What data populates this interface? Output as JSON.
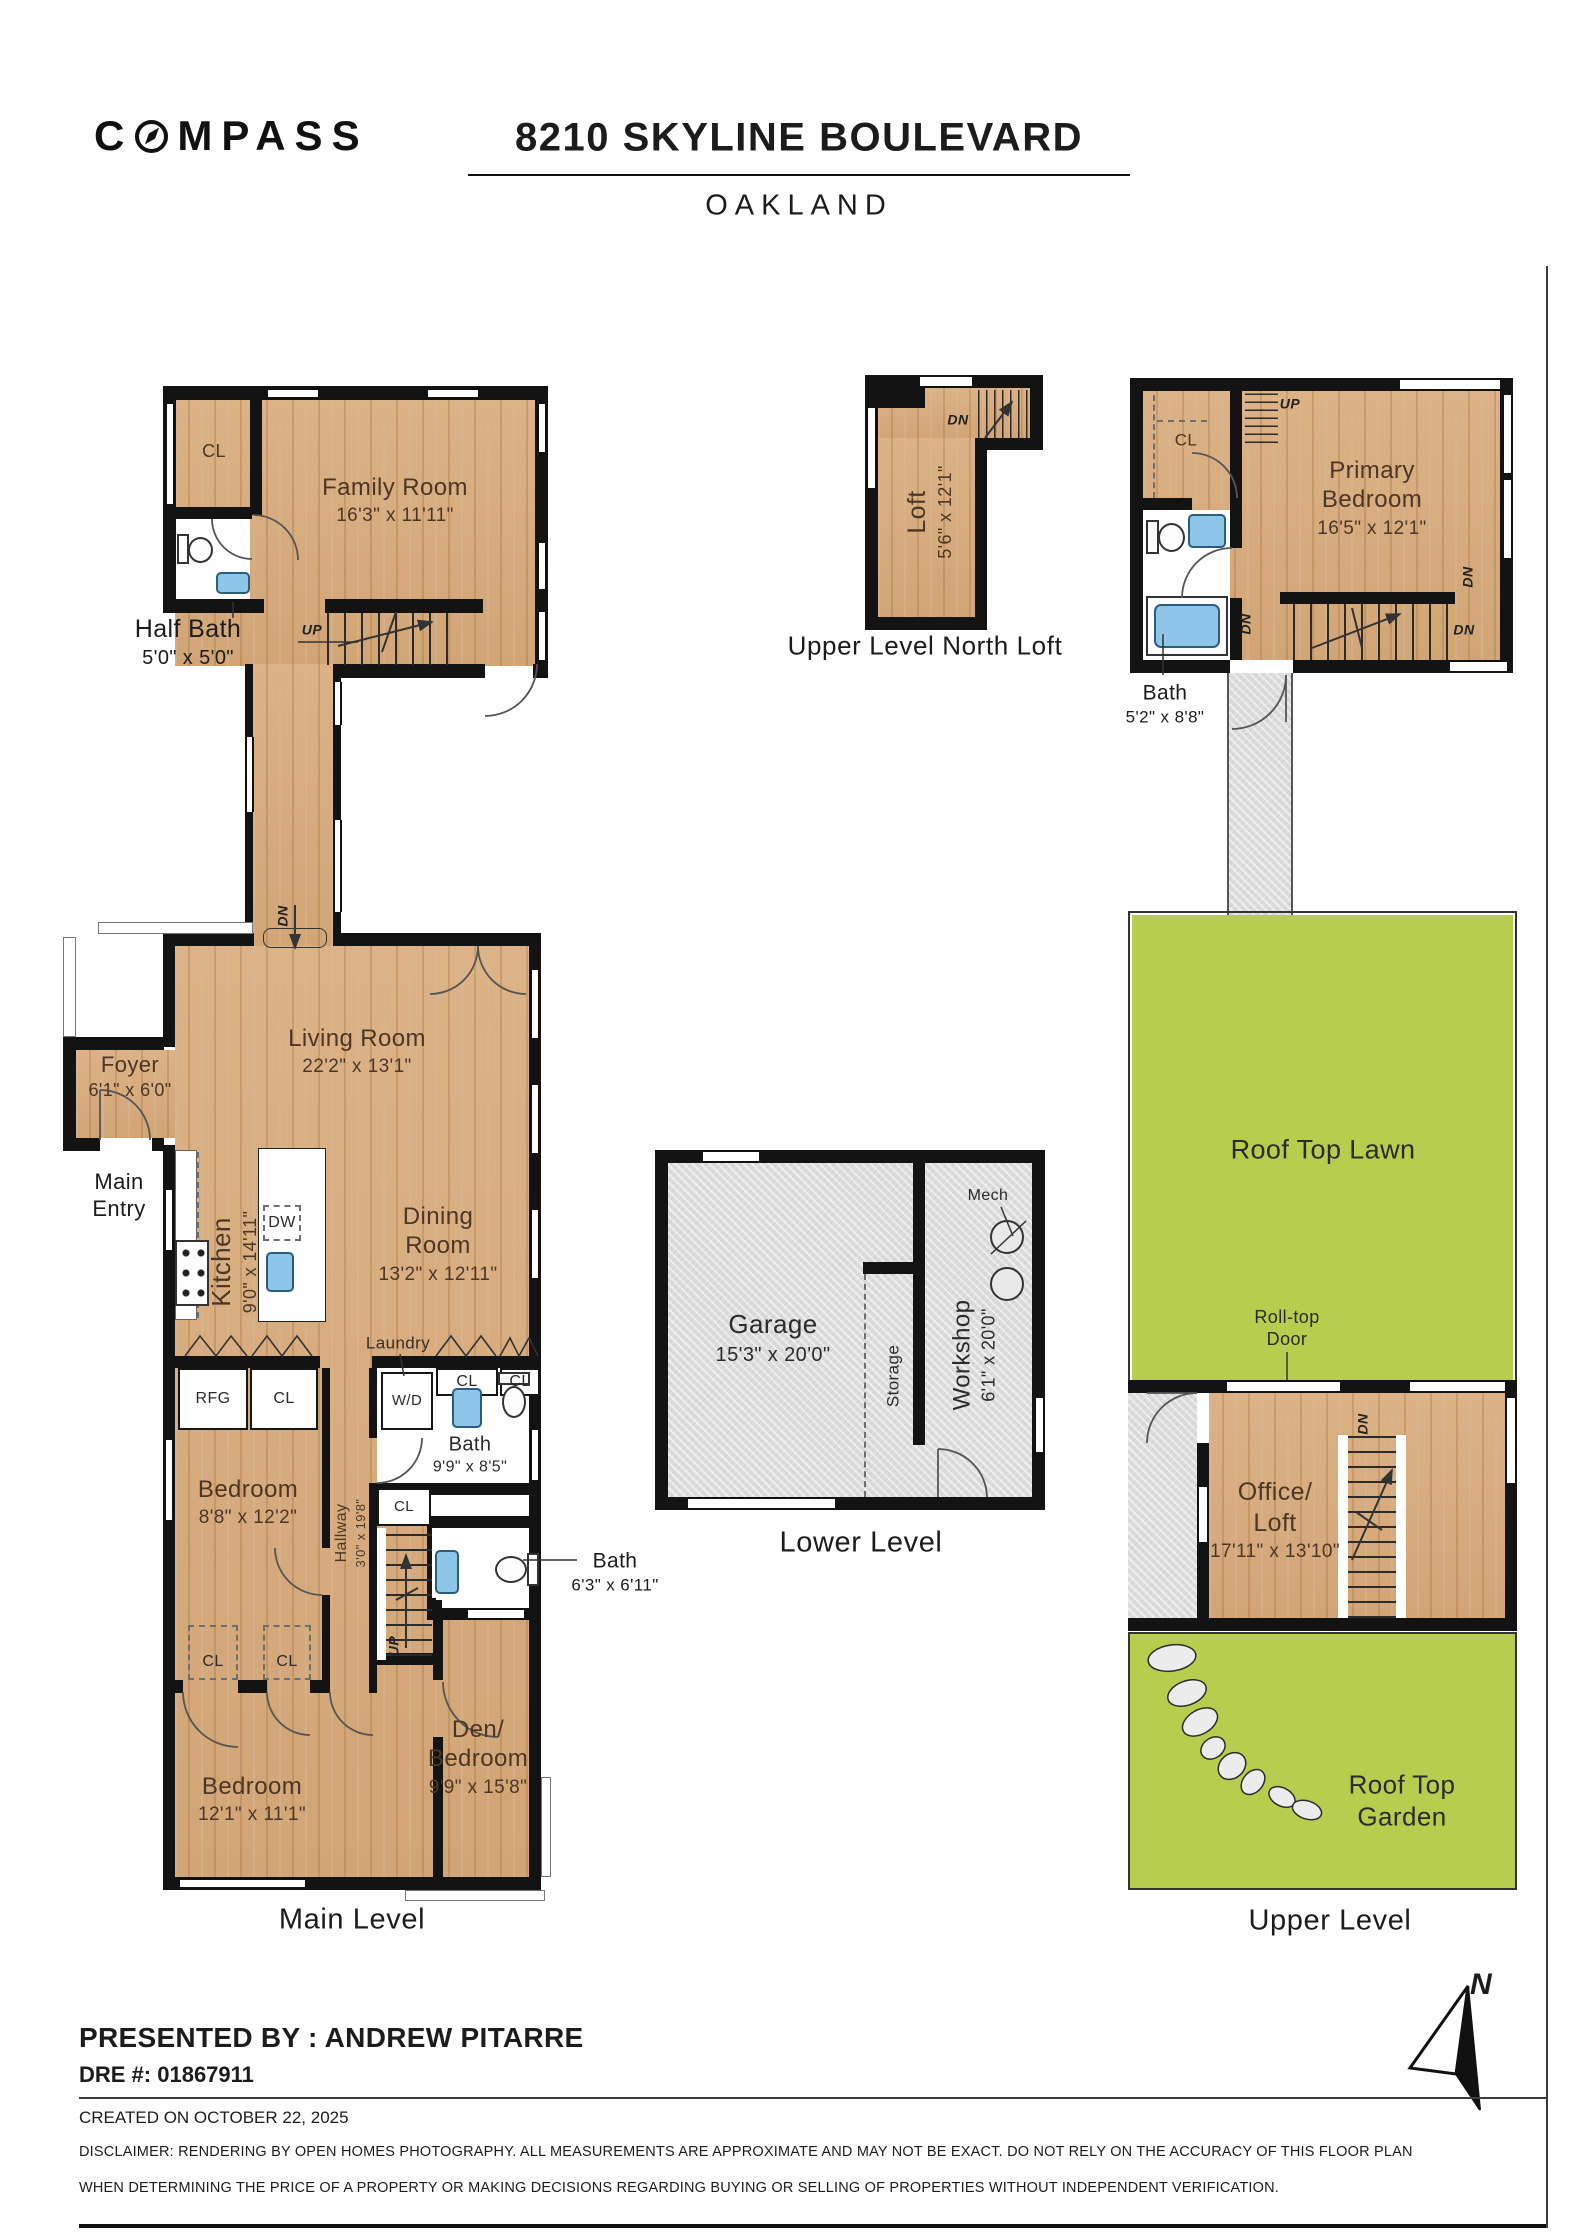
{
  "header": {
    "brand_c": "C",
    "brand_rest": "MPASS",
    "title": "8210 SKYLINE BOULEVARD",
    "subtitle": "OAKLAND"
  },
  "captions": {
    "north_loft": "Upper Level North Loft",
    "main_level": "Main Level",
    "lower_level": "Lower Level",
    "upper_level": "Upper Level"
  },
  "rooms": {
    "family_room": {
      "name": "Family Room",
      "dims": "16'3\" x 11'11\""
    },
    "half_bath": {
      "name": "Half Bath",
      "dims": "5'0\" x 5'0\""
    },
    "loft": {
      "name": "Loft",
      "dims": "5'6\" x 12'1\""
    },
    "primary": {
      "line1": "Primary",
      "line2": "Bedroom",
      "dims": "16'5\" x 12'1\""
    },
    "bath_upper": {
      "name": "Bath",
      "dims": "5'2\" x 8'8\""
    },
    "living": {
      "name": "Living Room",
      "dims": "22'2\" x 13'1\""
    },
    "foyer": {
      "name": "Foyer",
      "dims": "6'1\" x 6'0\""
    },
    "main_entry": {
      "line1": "Main",
      "line2": "Entry"
    },
    "kitchen": {
      "name": "Kitchen",
      "dims": "9'0\" x 14'11\""
    },
    "dining": {
      "line1": "Dining",
      "line2": "Room",
      "dims": "13'2\" x 12'11\""
    },
    "laundry": "Laundry",
    "bath_main": {
      "name": "Bath",
      "dims": "9'9\" x 8'5\""
    },
    "bath_hall": {
      "name": "Bath",
      "dims": "6'3\" x 6'11\""
    },
    "hallway": {
      "name": "Hallway",
      "dims": "3'0\" x 19'8\""
    },
    "bedroom_a": {
      "name": "Bedroom",
      "dims": "8'8\" x 12'2\""
    },
    "bedroom_b": {
      "name": "Bedroom",
      "dims": "12'1\" x 11'1\""
    },
    "den": {
      "line1": "Den/",
      "line2": "Bedroom",
      "dims": "9'9\" x 15'8\""
    },
    "garage": {
      "name": "Garage",
      "dims": "15'3\" x 20'0\""
    },
    "workshop": {
      "name": "Workshop",
      "dims": "6'1\" x 20'0\""
    },
    "storage": "Storage",
    "mech": "Mech",
    "lawn": "Roof Top Lawn",
    "roll_top": {
      "line1": "Roll-top",
      "line2": "Door"
    },
    "office": {
      "line1": "Office/",
      "line2": "Loft",
      "dims": "17'11\" x 13'10\""
    },
    "garden": {
      "line1": "Roof Top",
      "line2": "Garden"
    }
  },
  "markers": {
    "cl": "CL",
    "up": "UP",
    "dn": "DN",
    "rfg": "RFG",
    "dw": "DW",
    "wd": "W/D",
    "north": "N"
  },
  "footer": {
    "presented_by": "PRESENTED BY : ANDREW PITARRE",
    "dre": "DRE #: 01867911",
    "created": "CREATED ON OCTOBER 22, 2025",
    "disclaimer_line1": "DISCLAIMER: RENDERING BY OPEN HOMES PHOTOGRAPHY. ALL MEASUREMENTS ARE APPROXIMATE AND MAY NOT BE EXACT. DO NOT RELY ON THE ACCURACY OF THIS FLOOR PLAN",
    "disclaimer_line2": "WHEN DETERMINING THE PRICE OF A PROPERTY OR MAKING DECISIONS REGARDING BUYING OR SELLING OF PROPERTIES WITHOUT INDEPENDENT VERIFICATION."
  },
  "colors": {
    "wall": "#131313",
    "wood_floor": "#d8ad7e",
    "concrete": "#dcdcdc",
    "lawn_green": "#b6cd4d",
    "fixture_blue": "#8ec6ea",
    "label_brown": "#4c3625"
  }
}
